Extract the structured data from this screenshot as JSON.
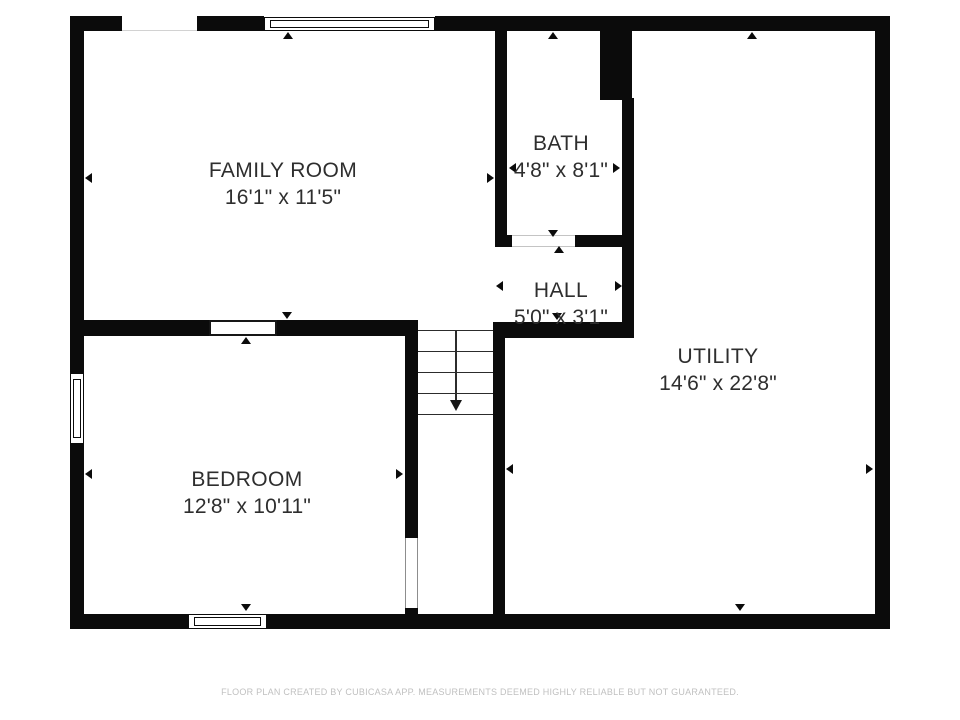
{
  "plan": {
    "rooms": {
      "family_room": {
        "name": "FAMILY ROOM",
        "dimensions": "16'1\" x 11'5\""
      },
      "bath": {
        "name": "BATH",
        "dimensions": "4'8\" x 8'1\""
      },
      "hall": {
        "name": "HALL",
        "dimensions": "5'0\" x 3'1\""
      },
      "utility": {
        "name": "UTILITY",
        "dimensions": "14'6\" x 22'8\""
      },
      "bedroom": {
        "name": "BEDROOM",
        "dimensions": "12'8\" x 10'11\""
      }
    },
    "footer": "FLOOR PLAN CREATED BY CUBICASA APP. MEASUREMENTS DEEMED HIGHLY RELIABLE BUT NOT GUARANTEED.",
    "colors": {
      "wall": "#0b0b0b",
      "label_text": "#2e2e2e",
      "footer_text": "#c0c0c0",
      "background": "#ffffff"
    }
  }
}
